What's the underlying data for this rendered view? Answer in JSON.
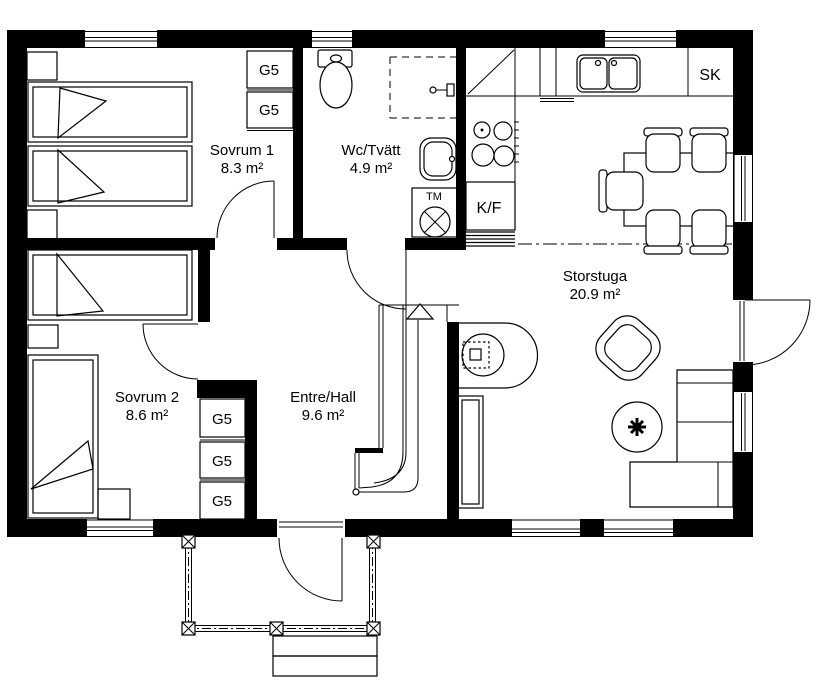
{
  "plan": {
    "rooms": [
      {
        "id": "sovrum1",
        "name": "Sovrum 1",
        "area": "8.3 m²"
      },
      {
        "id": "wc_tvatt",
        "name": "Wc/Tvätt",
        "area": "4.9 m²"
      },
      {
        "id": "storstuga",
        "name": "Storstuga",
        "area": "20.9 m²"
      },
      {
        "id": "sovrum2",
        "name": "Sovrum 2",
        "area": "8.6 m²"
      },
      {
        "id": "entre_hall",
        "name": "Entre/Hall",
        "area": "9.6 m²"
      }
    ],
    "fixtures": {
      "wardrobe": "G5",
      "fridge_freezer": "K/F",
      "cleaning_cabinet": "SK",
      "washing_machine": "TM"
    },
    "colors": {
      "line": "#000000",
      "background": "#ffffff"
    }
  }
}
